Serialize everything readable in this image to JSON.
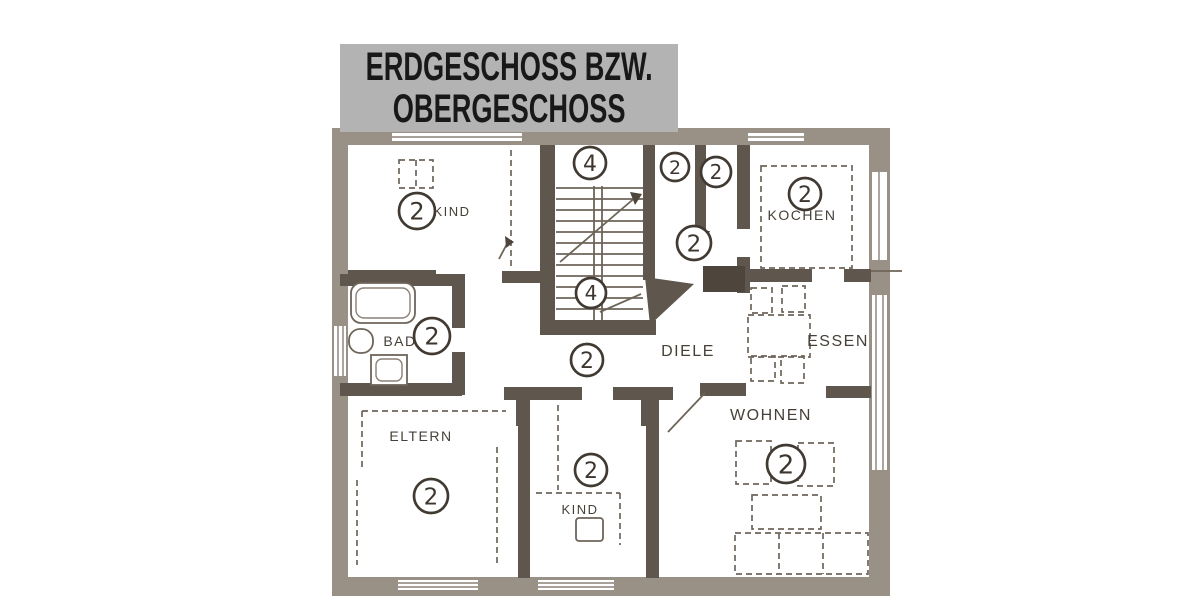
{
  "banner": {
    "line1": "ERDGESCHOSS BZW.",
    "line2": "OBERGESCHOSS"
  },
  "colors": {
    "banner_bg": "#b3b3b3",
    "banner_text": "#181818",
    "wall_outer": "#9a9186",
    "wall_inner": "#5f574d",
    "line": "#6e6559",
    "label_text": "#474038",
    "paper": "#ffffff"
  },
  "plan": {
    "room_labels": [
      {
        "id": "kind-top",
        "text": "KIND",
        "x": 452,
        "y": 216,
        "size": 13
      },
      {
        "id": "kochen",
        "text": "KOCHEN",
        "x": 802,
        "y": 220,
        "size": 14
      },
      {
        "id": "bad",
        "text": "BAD",
        "x": 400,
        "y": 346,
        "size": 14
      },
      {
        "id": "diele",
        "text": "DIELE",
        "x": 688,
        "y": 356,
        "size": 16
      },
      {
        "id": "essen",
        "text": "ESSEN",
        "x": 838,
        "y": 346,
        "size": 16
      },
      {
        "id": "eltern",
        "text": "ELTERN",
        "x": 421,
        "y": 441,
        "size": 14
      },
      {
        "id": "kind-bottom",
        "text": "KIND",
        "x": 580,
        "y": 514,
        "size": 13
      },
      {
        "id": "wohnen",
        "text": "WOHNEN",
        "x": 771,
        "y": 420,
        "size": 16
      }
    ],
    "markers": [
      {
        "id": "kind-top",
        "value": "2",
        "x": 417,
        "y": 211,
        "r": 18
      },
      {
        "id": "stairs-top",
        "value": "4",
        "x": 590,
        "y": 163,
        "r": 16
      },
      {
        "id": "stairs-bottom",
        "value": "4",
        "x": 591,
        "y": 293,
        "r": 15
      },
      {
        "id": "wc-left",
        "value": "2",
        "x": 675,
        "y": 167,
        "r": 14
      },
      {
        "id": "wc-right",
        "value": "2",
        "x": 716,
        "y": 172,
        "r": 15
      },
      {
        "id": "hall",
        "value": "2",
        "x": 694,
        "y": 243,
        "r": 17
      },
      {
        "id": "kochen",
        "value": "2",
        "x": 805,
        "y": 194,
        "r": 16
      },
      {
        "id": "bad",
        "value": "2",
        "x": 432,
        "y": 336,
        "r": 18
      },
      {
        "id": "diele",
        "value": "2",
        "x": 587,
        "y": 360,
        "r": 16
      },
      {
        "id": "eltern",
        "value": "2",
        "x": 431,
        "y": 496,
        "r": 17
      },
      {
        "id": "kind-bottom",
        "value": "2",
        "x": 591,
        "y": 470,
        "r": 16
      },
      {
        "id": "wohnen",
        "value": "2",
        "x": 786,
        "y": 464,
        "r": 19
      }
    ]
  }
}
